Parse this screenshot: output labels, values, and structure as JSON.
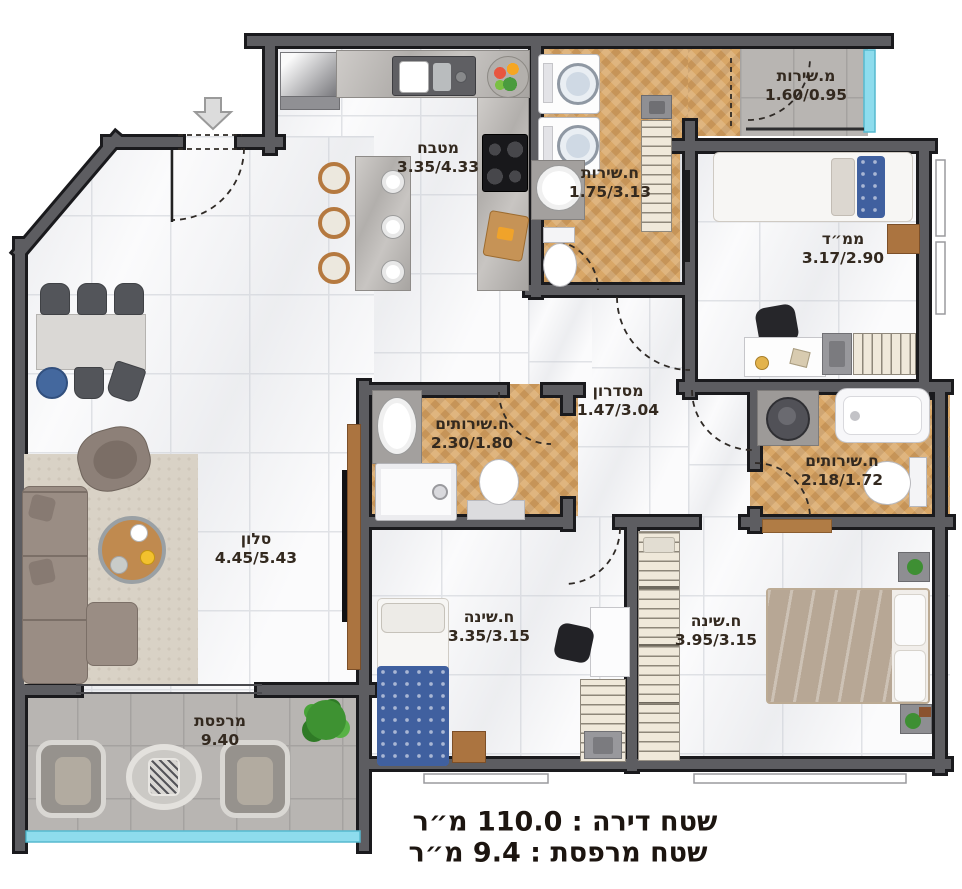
{
  "rooms": {
    "kitchen": {
      "name": "מטבח",
      "dims": "3.35/4.33"
    },
    "service_balcony": {
      "name": "מ.שירות",
      "dims": "1.60/0.95"
    },
    "bathroom_top": {
      "name": "ח.שירות",
      "dims": "1.75/3.13"
    },
    "mamad": {
      "name": "ממ״ד",
      "dims": "3.17/2.90"
    },
    "corridor": {
      "name": "מסדרון",
      "dims": "1.47/3.04"
    },
    "bathroom_middle": {
      "name": "ח.שירותים",
      "dims": "2.30/1.80"
    },
    "bathroom_right": {
      "name": "ח.שירותים",
      "dims": "2.18/1.72"
    },
    "living_room": {
      "name": "סלון",
      "dims": "4.45/5.43"
    },
    "bedroom_small": {
      "name": "ח.שינה",
      "dims": "3.35/3.15"
    },
    "bedroom_master": {
      "name": "ח.שינה",
      "dims": "3.95/3.15"
    },
    "balcony": {
      "name": "מרפסת",
      "dims": "9.40"
    }
  },
  "summary": {
    "apartment_area": "שטח דירה : 110.0 מ״ר",
    "balcony_area": "שטח מרפסת : 9.4 מ״ר"
  },
  "colors": {
    "wall": "#5d5d61",
    "wall_edge": "#1a1a1d",
    "wood_floor": "#d9a767",
    "gray_tile": "#b8b5b2",
    "glass": "#8edced",
    "label_text": "#33291f"
  }
}
